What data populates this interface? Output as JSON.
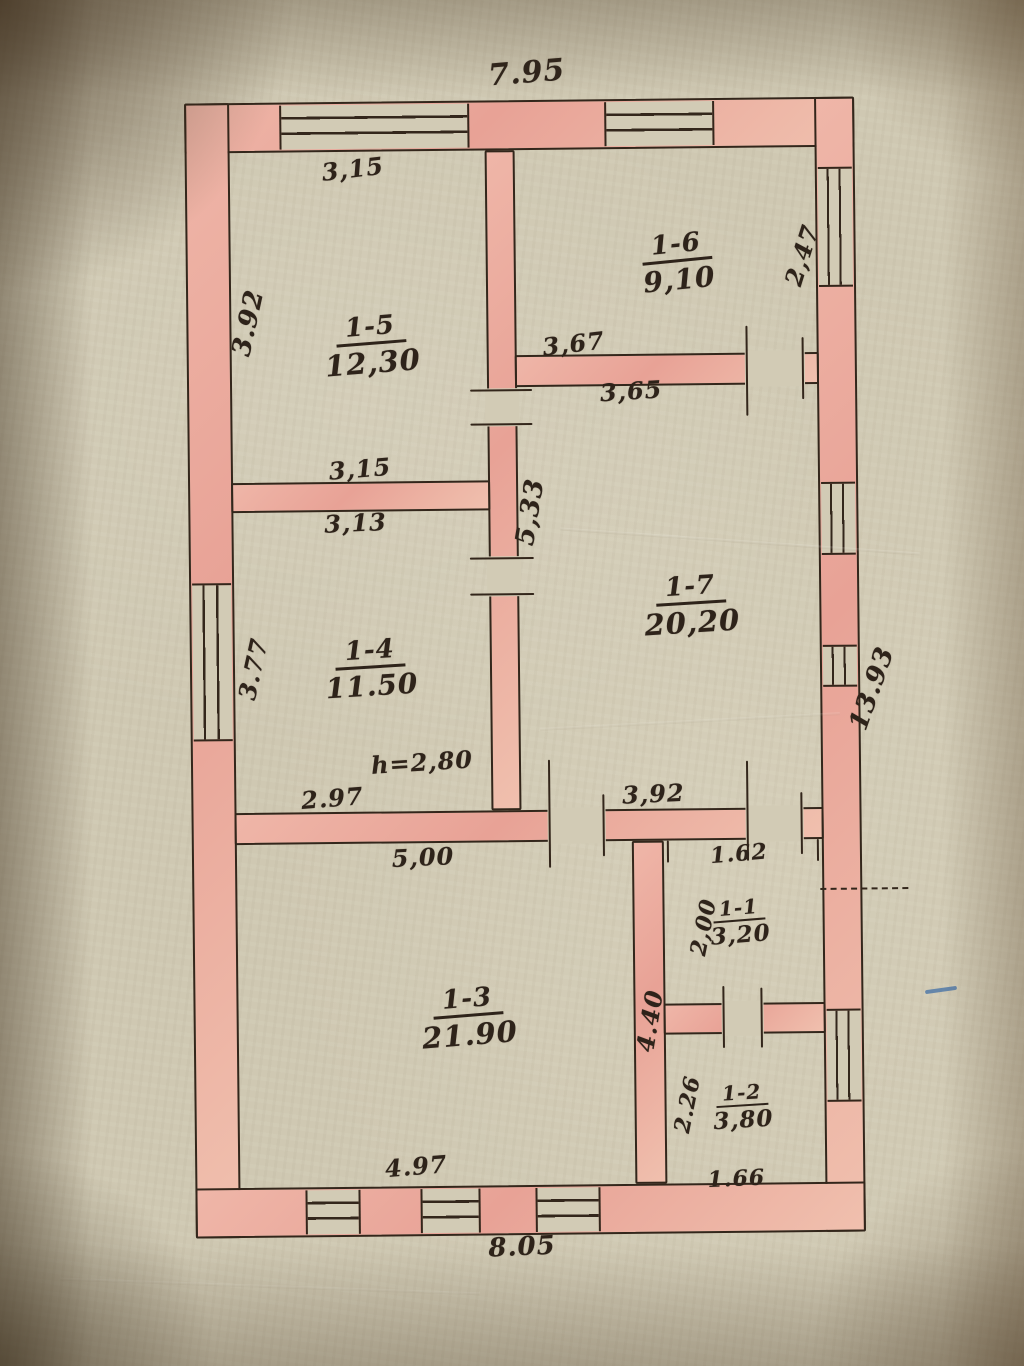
{
  "rooms": {
    "r15": {
      "num": "1-5",
      "area": "12,30"
    },
    "r16": {
      "num": "1-6",
      "area": "9,10"
    },
    "r17": {
      "num": "1-7",
      "area": "20,20"
    },
    "r14": {
      "num": "1-4",
      "area": "11.50"
    },
    "r13": {
      "num": "1-3",
      "area": "21.90"
    },
    "r11": {
      "num": "1-1",
      "area": "3,20"
    },
    "r12": {
      "num": "1-2",
      "area": "3,80"
    }
  },
  "dims": {
    "top_width": "7.95",
    "r15_top": "3,15",
    "left_upper": "3.92",
    "r16_right": "2,47",
    "wall16_above": "3,67",
    "wall16_below": "3,65",
    "corridor_vertical": "5,33",
    "wall15_above": "3,15",
    "wall15_below": "3,13",
    "left_middle": "3.77",
    "right_total": "13.93",
    "ceiling_height": "h=2,80",
    "wall14_above": "2.97",
    "wall17_below": "3,92",
    "wall13_above": "5,00",
    "r11_top": "1.62",
    "r11_left": "2,00",
    "r13_right": "4.40",
    "r12_left": "2.26",
    "r13_bottom": "4.97",
    "r12_bottom": "1.66",
    "bottom_width": "8.05"
  },
  "colors": {
    "paper": "#cfc8b2",
    "wall_fill": "#e8a296",
    "ink": "#33261b",
    "pen_mark_blue": "#4a74a8"
  }
}
